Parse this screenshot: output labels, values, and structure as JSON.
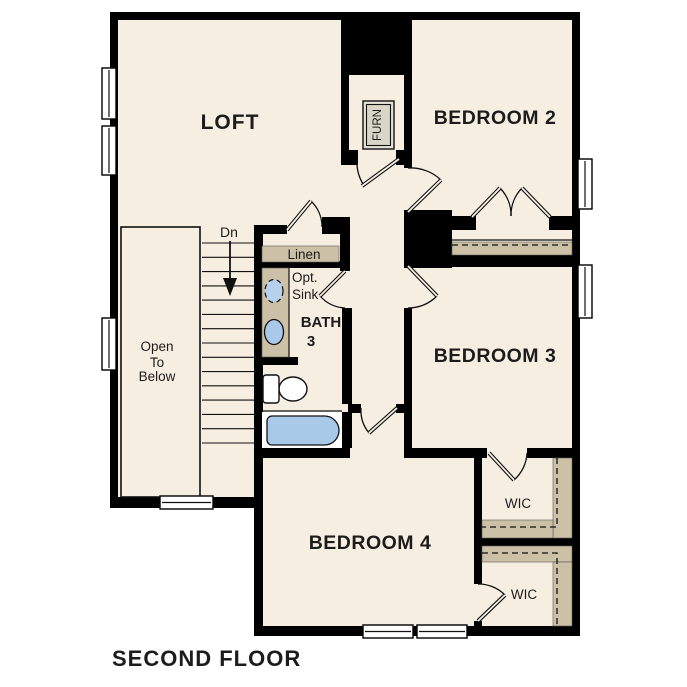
{
  "title": "SECOND FLOOR",
  "colors": {
    "floor": "#f6eee1",
    "wall": "#000000",
    "shelf_tan": "#ccc0a6",
    "fixture_blue": "#a9c9e9",
    "background": "#ffffff"
  },
  "rooms": {
    "loft": "LOFT",
    "bedroom2": "BEDROOM 2",
    "bedroom3": "BEDROOM 3",
    "bedroom4": "BEDROOM 4",
    "bath_name": "BATH",
    "bath_number": "3",
    "linen": "Linen",
    "wic_upper": "WIC",
    "wic_lower": "WIC",
    "furnace": "FURN"
  },
  "annotations": {
    "stair_direction": "Dn",
    "open_below_line1": "Open",
    "open_below_line2": "To",
    "open_below_line3": "Below",
    "optional_sink_line1": "Opt.",
    "optional_sink_line2": "Sink"
  }
}
